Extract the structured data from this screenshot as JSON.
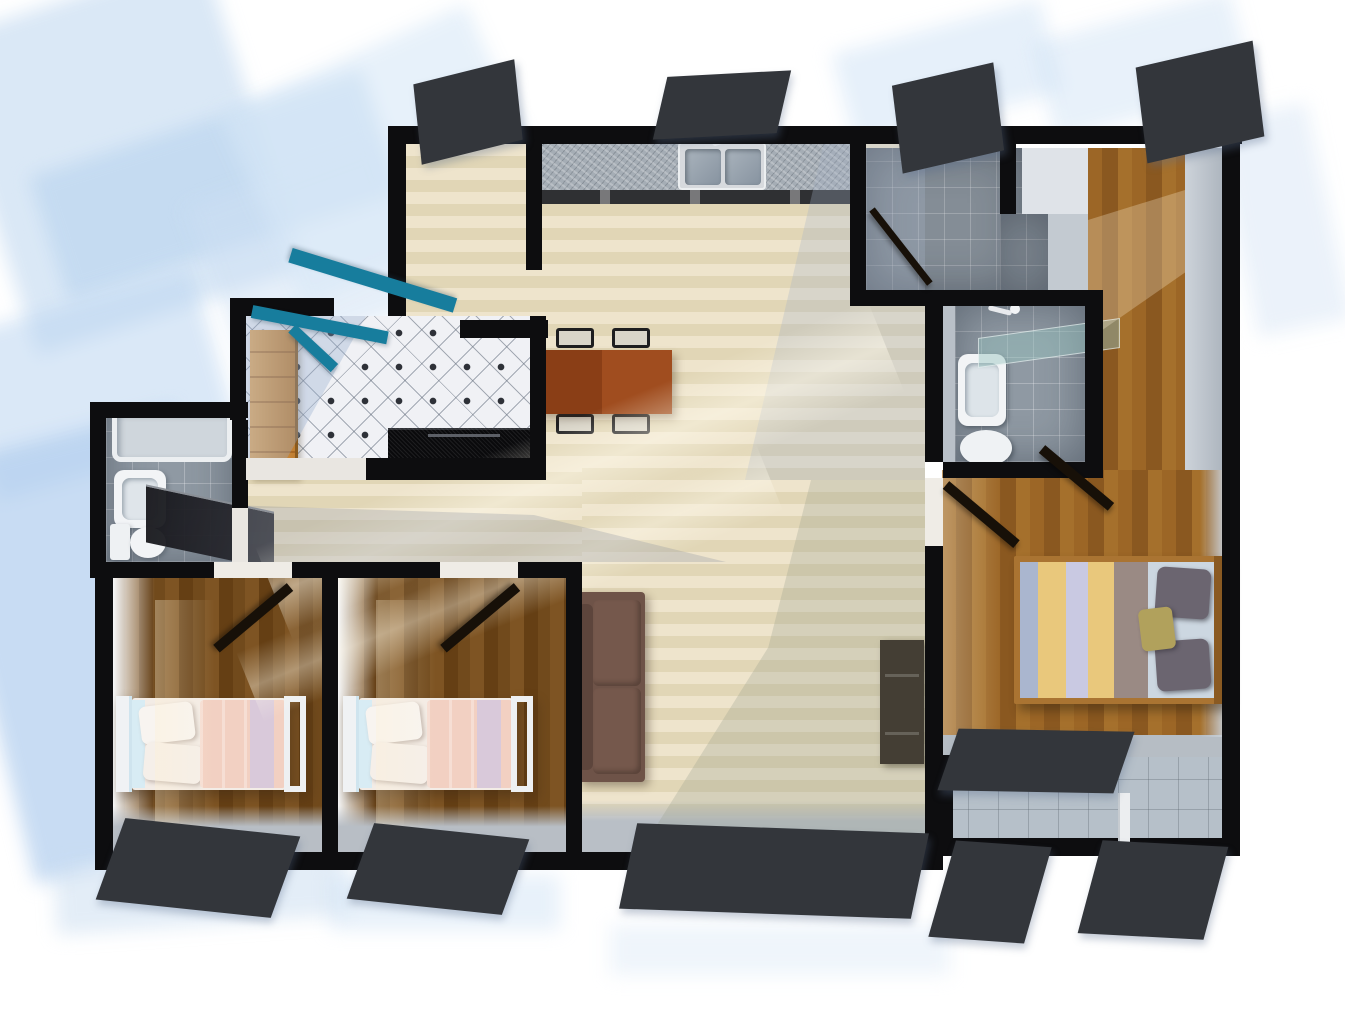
{
  "scene": {
    "kind": "3d-rendered-floor-plan",
    "view": "top-down-axonometric",
    "background": "#ffffff"
  },
  "palette": {
    "bg": "#ffffff",
    "wall": "#0d0d0f",
    "door-dark": "#171008",
    "teal": "#177d9d",
    "floor-light": "#e8dec3",
    "wood-dark": "#6f4518",
    "wood-mid": "#96621f",
    "tile-white": "#f0f1f5",
    "tile-gray": "#8f99a3",
    "tile-balcony": "#b6c0c9",
    "granite": "#a5adb5",
    "counter-black": "#0a0a0c",
    "oak": "#d89a4e",
    "sofa": "#6e5348",
    "table": "#95451c",
    "bed-pink": "#f2d0c2",
    "bed-white": "#f4efe9",
    "stripe-gold": "#e9c87c",
    "stripe-blue": "#aab6cf",
    "stripe-lavender": "#c9c9e2",
    "stripe-taupe": "#9a8a84",
    "sheet-blue": "#ccd7e1",
    "pillow-gray": "#6b6570",
    "pillow-olive": "#b1a15c",
    "wood-frame": "#aa7432",
    "glass": "rgba(150,195,190,0.45)",
    "shadow-blue": "#bcd4ee",
    "window-frame": "#33363b"
  },
  "rooms": {
    "living": {
      "label": "living-dining-area"
    },
    "kitchen": {
      "label": "kitchen"
    },
    "foyer": {
      "label": "tiled-foyer"
    },
    "hall": {
      "label": "hallway"
    },
    "bath_left": {
      "label": "bathroom-left"
    },
    "bedroom1": {
      "label": "bedroom-1"
    },
    "bedroom2": {
      "label": "bedroom-2"
    },
    "bath_top": {
      "label": "bathroom-top-right"
    },
    "ensuite": {
      "label": "ensuite-bathroom"
    },
    "corridor": {
      "label": "master-corridor"
    },
    "master": {
      "label": "master-bedroom"
    },
    "balcony": {
      "label": "balcony"
    }
  },
  "furniture": {
    "kitchen_counter": {
      "label": "granite-kitchen-counter"
    },
    "kitchen_sink": {
      "label": "double-basin-sink"
    },
    "dark_counter": {
      "label": "black-counter"
    },
    "wardrobe": {
      "label": "oak-cabinet"
    },
    "dining_table": {
      "label": "dining-table",
      "chairs": 4
    },
    "sofa": {
      "label": "sofa"
    },
    "tv_cabinet": {
      "label": "tv-cabinet"
    },
    "bathtub": {
      "label": "bathtub"
    },
    "basin_left": {
      "label": "wash-basin"
    },
    "toilet_left": {
      "label": "toilet"
    },
    "shower_screen": {
      "label": "dark-shower-screen"
    },
    "bed1": {
      "label": "single-bed-pink"
    },
    "bed2": {
      "label": "single-bed-pink"
    },
    "master_bed": {
      "label": "double-bed-striped"
    },
    "ensuite_glass": {
      "label": "glass-shower-panel"
    },
    "ensuite_basin": {
      "label": "wash-basin"
    },
    "ensuite_toilet": {
      "label": "toilet"
    },
    "entry_door": {
      "label": "entry-door-teal"
    },
    "interior_doors": {
      "label": "interior-door",
      "count": 5
    },
    "balcony_slider": {
      "label": "balcony-sliding-frame"
    },
    "windows": {
      "label": "window",
      "count": 9
    }
  }
}
